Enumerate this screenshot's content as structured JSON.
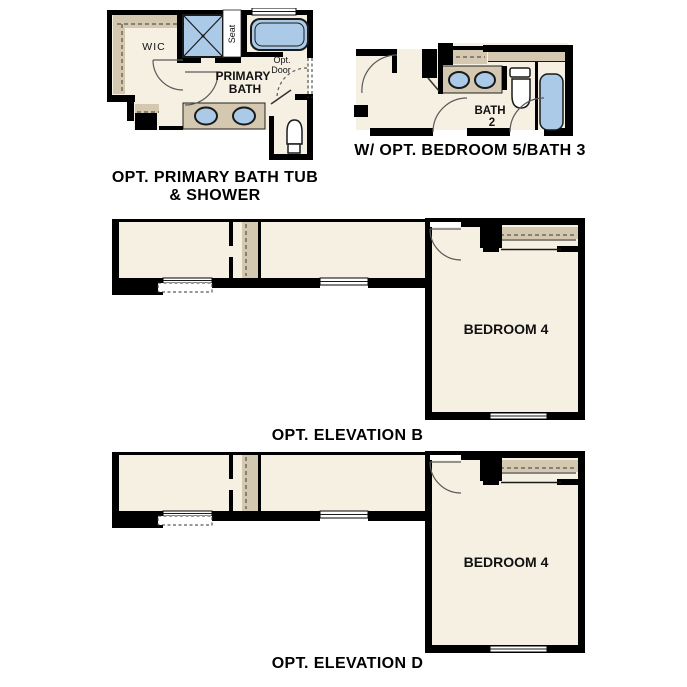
{
  "colors": {
    "background": "#ffffff",
    "wall": "#000000",
    "floor": "#f6f0e3",
    "shelf": "#d4c8b0",
    "fixture": "#abcae8",
    "text": "#000000"
  },
  "plans": {
    "primary_bath": {
      "labels": {
        "wic": "WIC",
        "seat": "Seat",
        "room_line1": "PRIMARY",
        "room_line2": "BATH",
        "opt_door_line1": "Opt.",
        "opt_door_line2": "Door"
      },
      "caption_line1": "OPT. PRIMARY BATH TUB",
      "caption_line2": "& SHOWER"
    },
    "bedroom5_bath3": {
      "labels": {
        "bath_line1": "BATH",
        "bath_line2": "2"
      },
      "caption": "W/ OPT. BEDROOM 5/BATH 3"
    },
    "elevation_b": {
      "labels": {
        "bedroom": "BEDROOM 4"
      },
      "caption": "OPT. ELEVATION B"
    },
    "elevation_d": {
      "labels": {
        "bedroom": "BEDROOM 4"
      },
      "caption": "OPT. ELEVATION D"
    }
  }
}
